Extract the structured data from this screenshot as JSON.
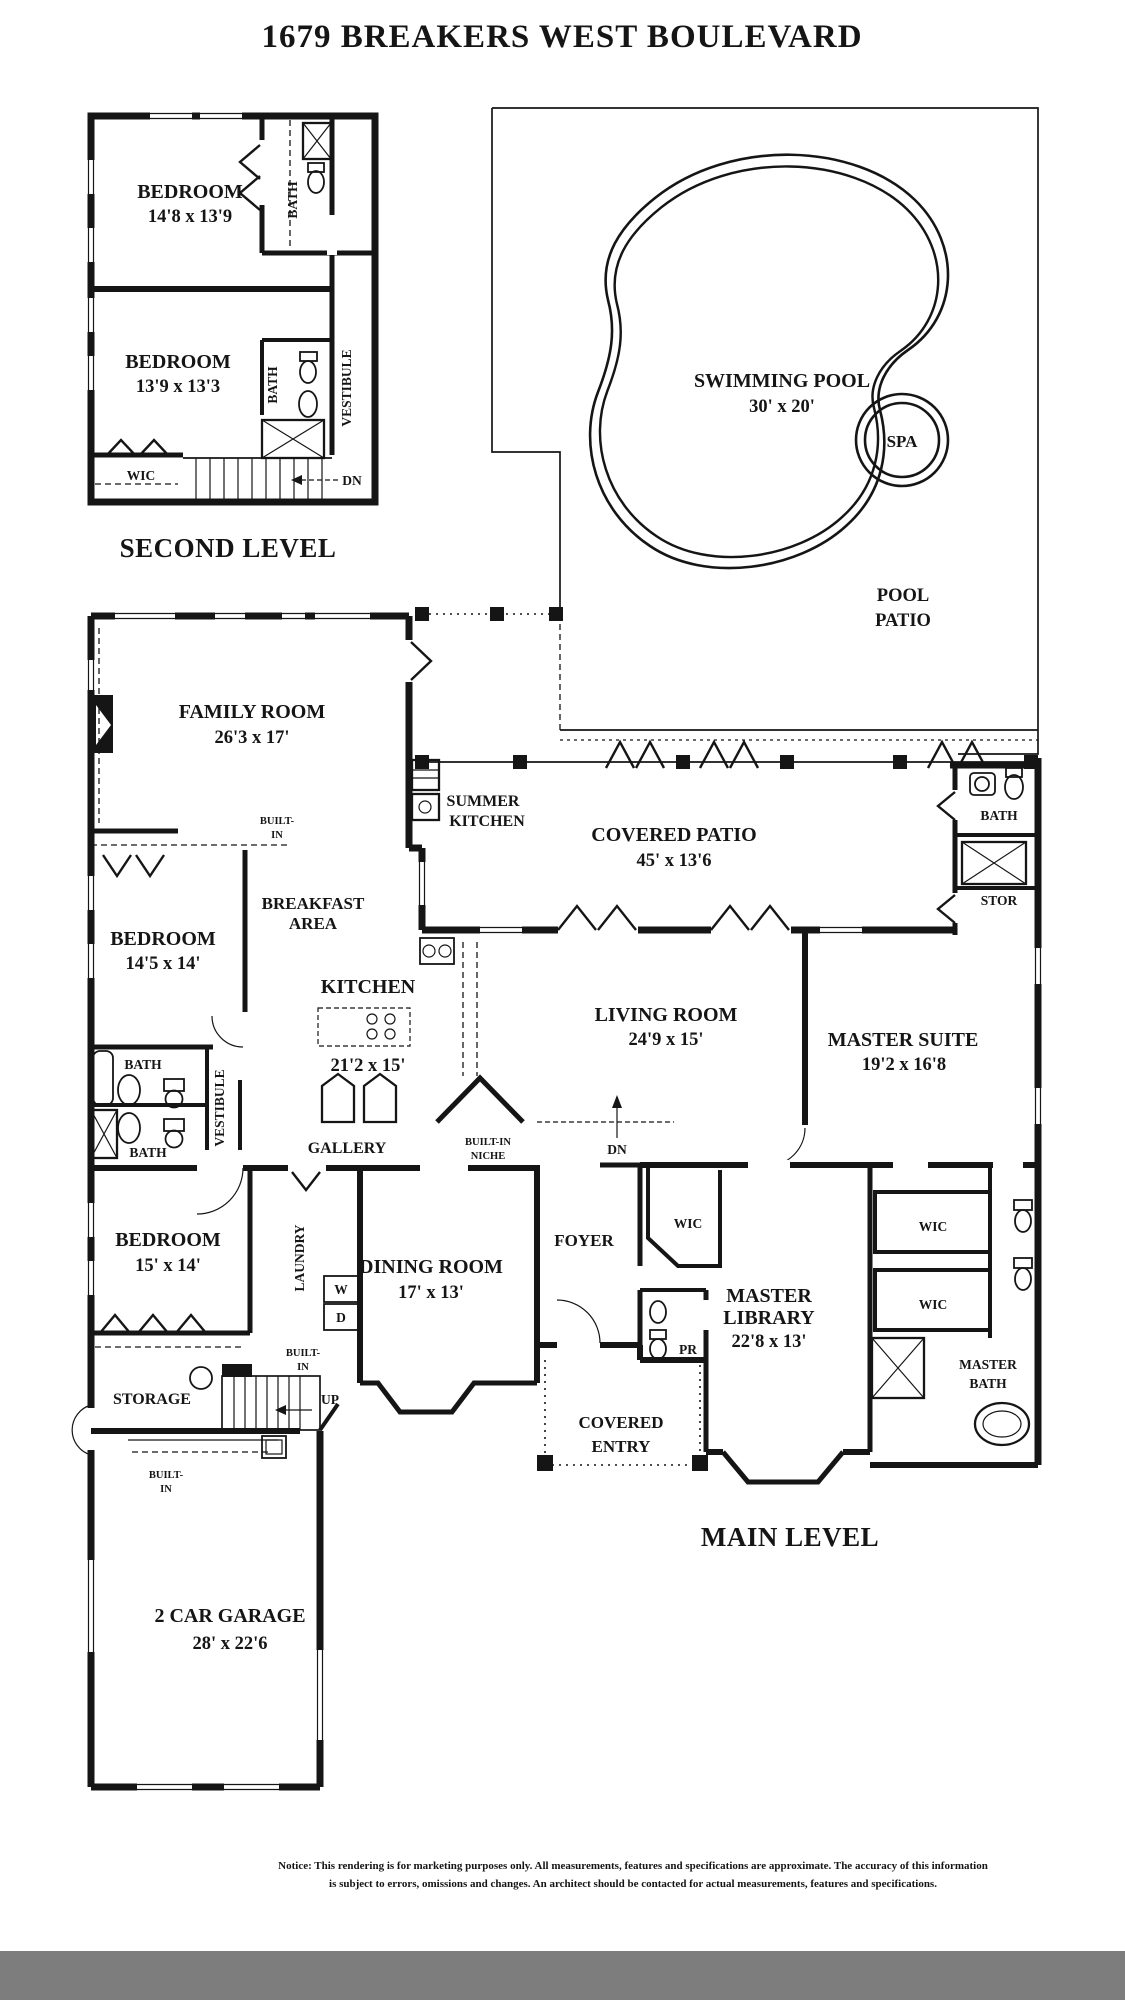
{
  "title": "1679 BREAKERS WEST BOULEVARD",
  "second_level": {
    "caption": "SECOND LEVEL",
    "bedroom_a": {
      "name": "BEDROOM",
      "dim": "14'8 x 13'9"
    },
    "bedroom_b": {
      "name": "BEDROOM",
      "dim": "13'9 x 13'3"
    },
    "bath_a": "BATH",
    "bath_b": "BATH",
    "vestibule": "VESTIBULE",
    "wic": "WIC",
    "dn": "DN"
  },
  "pool_area": {
    "swimming_pool": {
      "name": "SWIMMING POOL",
      "dim": "30' x 20'"
    },
    "spa": "SPA",
    "pool_patio": {
      "line1": "POOL",
      "line2": "PATIO"
    }
  },
  "main_level": {
    "caption": "MAIN LEVEL",
    "family_room": {
      "name": "FAMILY ROOM",
      "dim": "26'3 x 17'"
    },
    "built_in_family": {
      "line1": "BUILT-",
      "line2": "IN"
    },
    "summer_kitchen": {
      "line1": "SUMMER",
      "line2": "KITCHEN"
    },
    "covered_patio": {
      "name": "COVERED PATIO",
      "dim": "45' x 13'6"
    },
    "patio_bath": "BATH",
    "stor": "STOR",
    "bedroom_c": {
      "name": "BEDROOM",
      "dim": "14'5 x 14'"
    },
    "breakfast_area": {
      "line1": "BREAKFAST",
      "line2": "AREA"
    },
    "kitchen": {
      "name": "KITCHEN",
      "dim": "21'2 x 15'"
    },
    "living_room": {
      "name": "LIVING ROOM",
      "dim": "24'9 x 15'"
    },
    "master_suite": {
      "name": "MASTER SUITE",
      "dim": "19'2 x 16'8"
    },
    "bath_c": "BATH",
    "bath_d": "BATH",
    "vestibule": "VESTIBULE",
    "gallery": "GALLERY",
    "built_in_niche": {
      "line1": "BUILT-IN",
      "line2": "NICHE"
    },
    "dn": "DN",
    "bedroom_d": {
      "name": "BEDROOM",
      "dim": "15' x 14'"
    },
    "laundry": "LAUNDRY",
    "washer": "W",
    "dryer": "D",
    "dining_room": {
      "name": "DINING ROOM",
      "dim": "17' x 13'"
    },
    "foyer": "FOYER",
    "wic_foyer": "WIC",
    "powder_room": "PR",
    "master_library": {
      "line1": "MASTER",
      "line2": "LIBRARY",
      "dim": "22'8 x 13'"
    },
    "wic_master_a": "WIC",
    "wic_master_b": "WIC",
    "master_bath": {
      "line1": "MASTER",
      "line2": "BATH"
    },
    "storage": "STORAGE",
    "up": "UP",
    "built_in_stairs": {
      "line1": "BUILT-",
      "line2": "IN"
    },
    "built_in_garage": {
      "line1": "BUILT-",
      "line2": "IN"
    },
    "covered_entry": {
      "line1": "COVERED",
      "line2": "ENTRY"
    },
    "garage": {
      "name": "2 CAR GARAGE",
      "dim": "28' x 22'6"
    }
  },
  "notice": {
    "line1": "Notice: This rendering is for marketing purposes only. All measurements, features and specifications are approximate. The accuracy of this information",
    "line2": "is subject to errors, omissions and changes. An architect should be contacted for actual measurements, features and specifications."
  },
  "colors": {
    "ink": "#151515",
    "paper": "#ffffff",
    "bottom_bar": "#7d7d7d"
  }
}
